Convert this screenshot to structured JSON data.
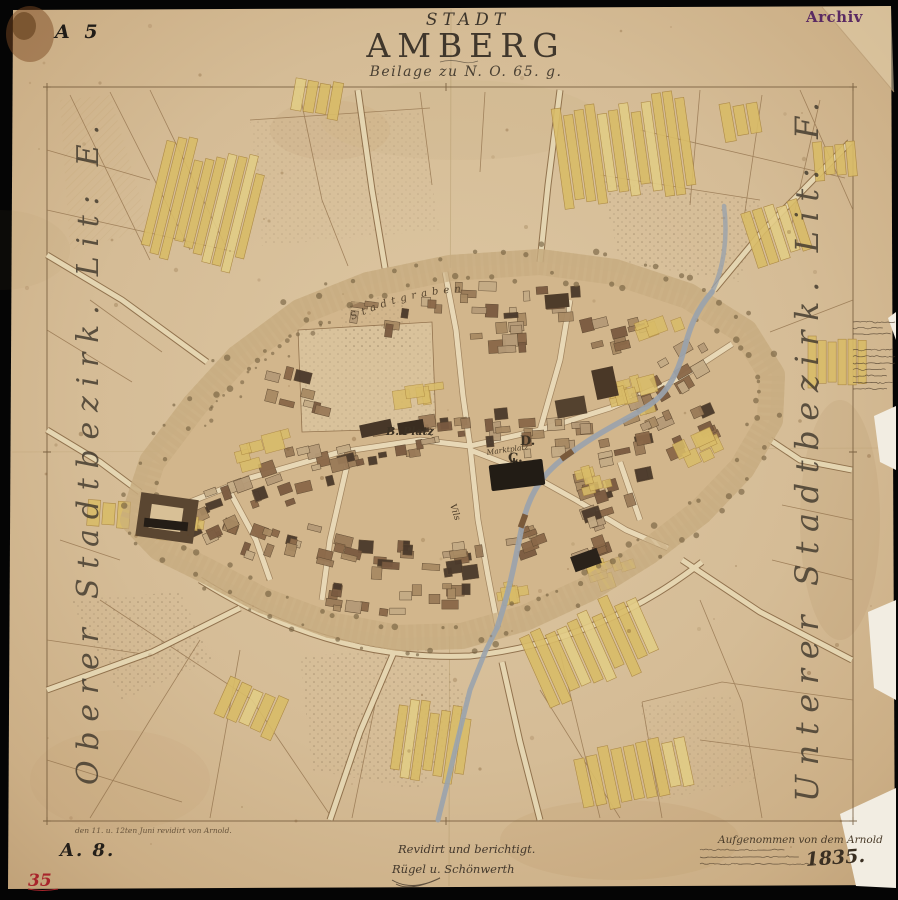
{
  "artifact": {
    "archive_stamp": "Archiv",
    "sheet_label": "A 5",
    "red_inventory_no": "35"
  },
  "title": {
    "kicker": "STADT",
    "name": "AMBERG",
    "subtitle": "Beilage zu N. O. 65. g."
  },
  "margins": {
    "left_vertical": "Oberer Stadtbezirk. Lit: E.",
    "right_vertical": "Unterer Stadtbezirk. Lit: F."
  },
  "map_labels": {
    "moat": "Stadtgraben",
    "market_square": "Marktplatz",
    "river": "Vils",
    "district_b": "B. Platz",
    "district_c": "C.",
    "district_d": "D."
  },
  "footer": {
    "revision_note": "den 11. u. 12ten Juni revidirt von Arnold.",
    "plate_label": "A. 8.",
    "signature_line1": "Revidirt und berichtigt.",
    "signature_line2": "Rügel   u. Schönwerth",
    "survey_line": "Aufgenommen von dem Arnold",
    "year": "1835."
  },
  "colors": {
    "paper": "#d5bc96",
    "ink": "#6b5233",
    "parcel_yellow": "#d9bc68",
    "building_dark": "#4a392b",
    "building_black": "#241d16",
    "river_blue": "#9aa3ad",
    "stamp_purple": "#5a2a63",
    "stamp_red": "#a8242b"
  }
}
